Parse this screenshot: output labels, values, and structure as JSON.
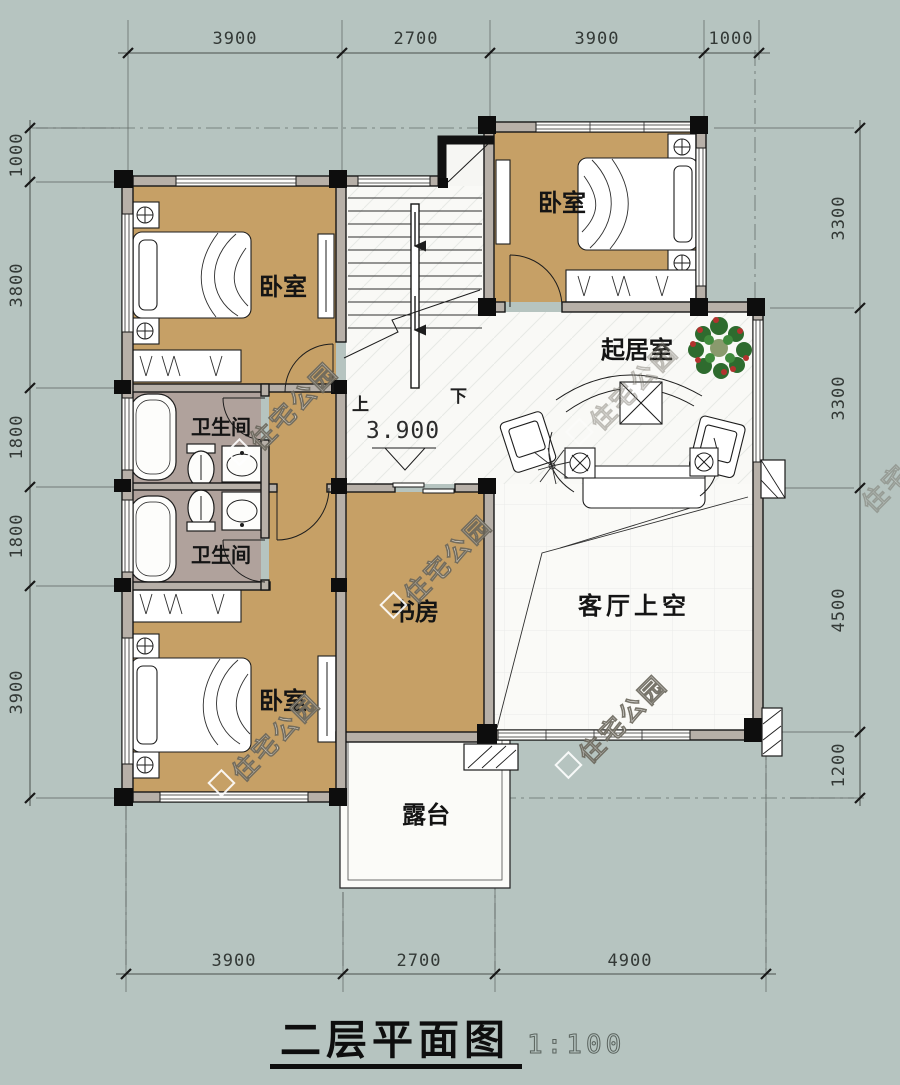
{
  "title": {
    "text": "二层平面图",
    "scale": "1:100"
  },
  "dimensions": {
    "top": [
      "3900",
      "2700",
      "3900",
      "1000"
    ],
    "bottom": [
      "3900",
      "2700",
      "4900"
    ],
    "left": [
      "1000",
      "3800",
      "1800",
      "1800",
      "3900"
    ],
    "right": [
      "3300",
      "3300",
      "4500",
      "1200"
    ]
  },
  "rooms": {
    "bedroom_top_left": "卧室",
    "bedroom_top_right": "卧室",
    "bedroom_bottom": "卧室",
    "bathroom_upper": "卫生间",
    "bathroom_lower": "卫生间",
    "living": "起居室",
    "study": "书房",
    "void_over_living": "客厅上空",
    "terrace": "露台"
  },
  "stairs": {
    "up": "上",
    "down": "下",
    "elevation": "3.900"
  },
  "watermark": "住宅公园",
  "colors": {
    "background": "#b6c4c0",
    "floor_room": "#c6a066",
    "floor_bath": "#b0a29c",
    "floor_tile": "#f9f9f6",
    "wall": "#161616",
    "wall_core": "#b7b0a8",
    "dimension": "#333936",
    "plant_green": "#2e6b2e",
    "plant_red": "#b3322e"
  }
}
